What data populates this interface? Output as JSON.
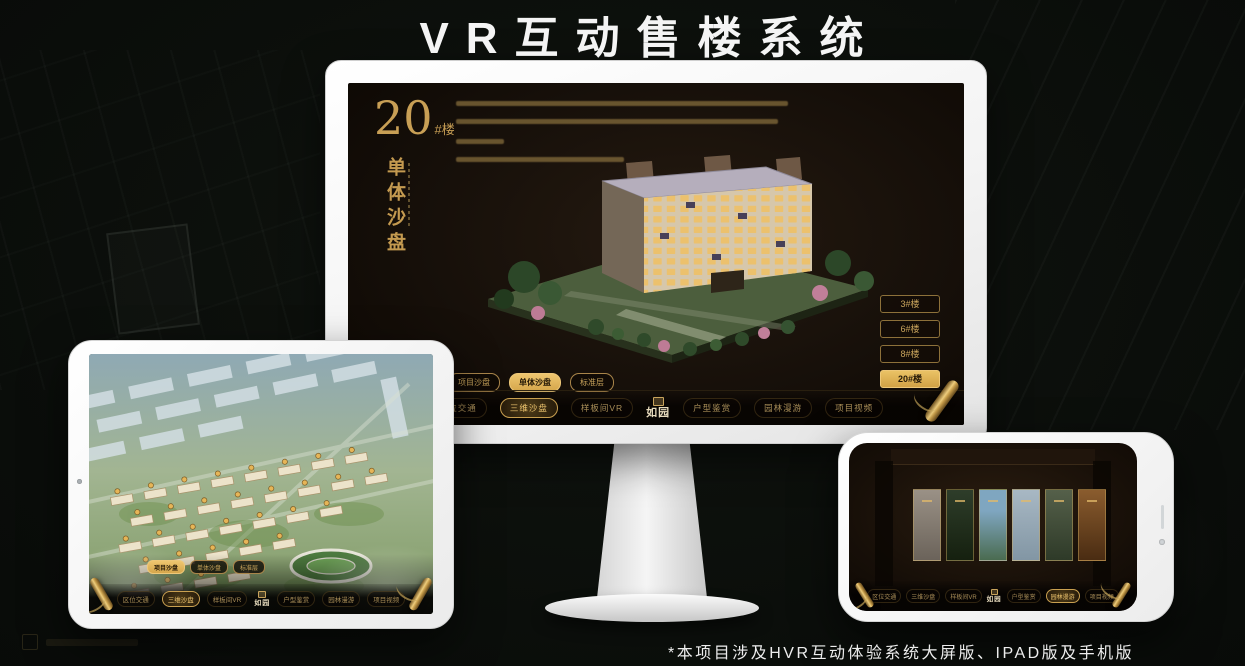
{
  "page": {
    "title": "VR互动售楼系统",
    "footer_note": "*本项目涉及HVR互动体验系统大屏版、IPAD版及手机版"
  },
  "colors": {
    "gold": "#c9a45b",
    "gold_active": "#e3b964",
    "screen_bg": "#17100a",
    "monitor_body": "#f3f3f3"
  },
  "brand": {
    "logo": "如园"
  },
  "monitor": {
    "heading": {
      "number": "20",
      "suffix": "#楼",
      "subtitle": "单体沙盘"
    },
    "floor_buttons": [
      {
        "label": "3#楼",
        "active": false
      },
      {
        "label": "6#楼",
        "active": false
      },
      {
        "label": "8#楼",
        "active": false
      },
      {
        "label": "20#楼",
        "active": true
      }
    ],
    "sub_tabs": [
      {
        "label": "项目沙盘",
        "active": false
      },
      {
        "label": "单体沙盘",
        "active": true
      },
      {
        "label": "标准层",
        "active": false
      }
    ],
    "nav_items": [
      {
        "label": "区位交通",
        "active": false
      },
      {
        "label": "三维沙盘",
        "active": true
      },
      {
        "label": "样板间VR",
        "active": false
      },
      {
        "label": "户型鉴赏",
        "active": false
      },
      {
        "label": "园林漫游",
        "active": false
      },
      {
        "label": "项目视频",
        "active": false
      }
    ]
  },
  "ipad": {
    "sub_tabs": [
      {
        "label": "项目沙盘",
        "active": true
      },
      {
        "label": "单体沙盘",
        "active": false
      },
      {
        "label": "标准层",
        "active": false
      }
    ],
    "nav_items": [
      {
        "label": "区位交通",
        "active": false
      },
      {
        "label": "三维沙盘",
        "active": true
      },
      {
        "label": "样板间VR",
        "active": false
      },
      {
        "label": "户型鉴赏",
        "active": false
      },
      {
        "label": "园林漫游",
        "active": false
      },
      {
        "label": "项目视频",
        "active": false
      }
    ]
  },
  "phone": {
    "nav_items": [
      {
        "label": "区位交通",
        "active": false
      },
      {
        "label": "三维沙盘",
        "active": false
      },
      {
        "label": "样板间VR",
        "active": false
      },
      {
        "label": "户型鉴赏",
        "active": false
      },
      {
        "label": "园林漫游",
        "active": true
      },
      {
        "label": "项目视频",
        "active": false
      }
    ]
  }
}
